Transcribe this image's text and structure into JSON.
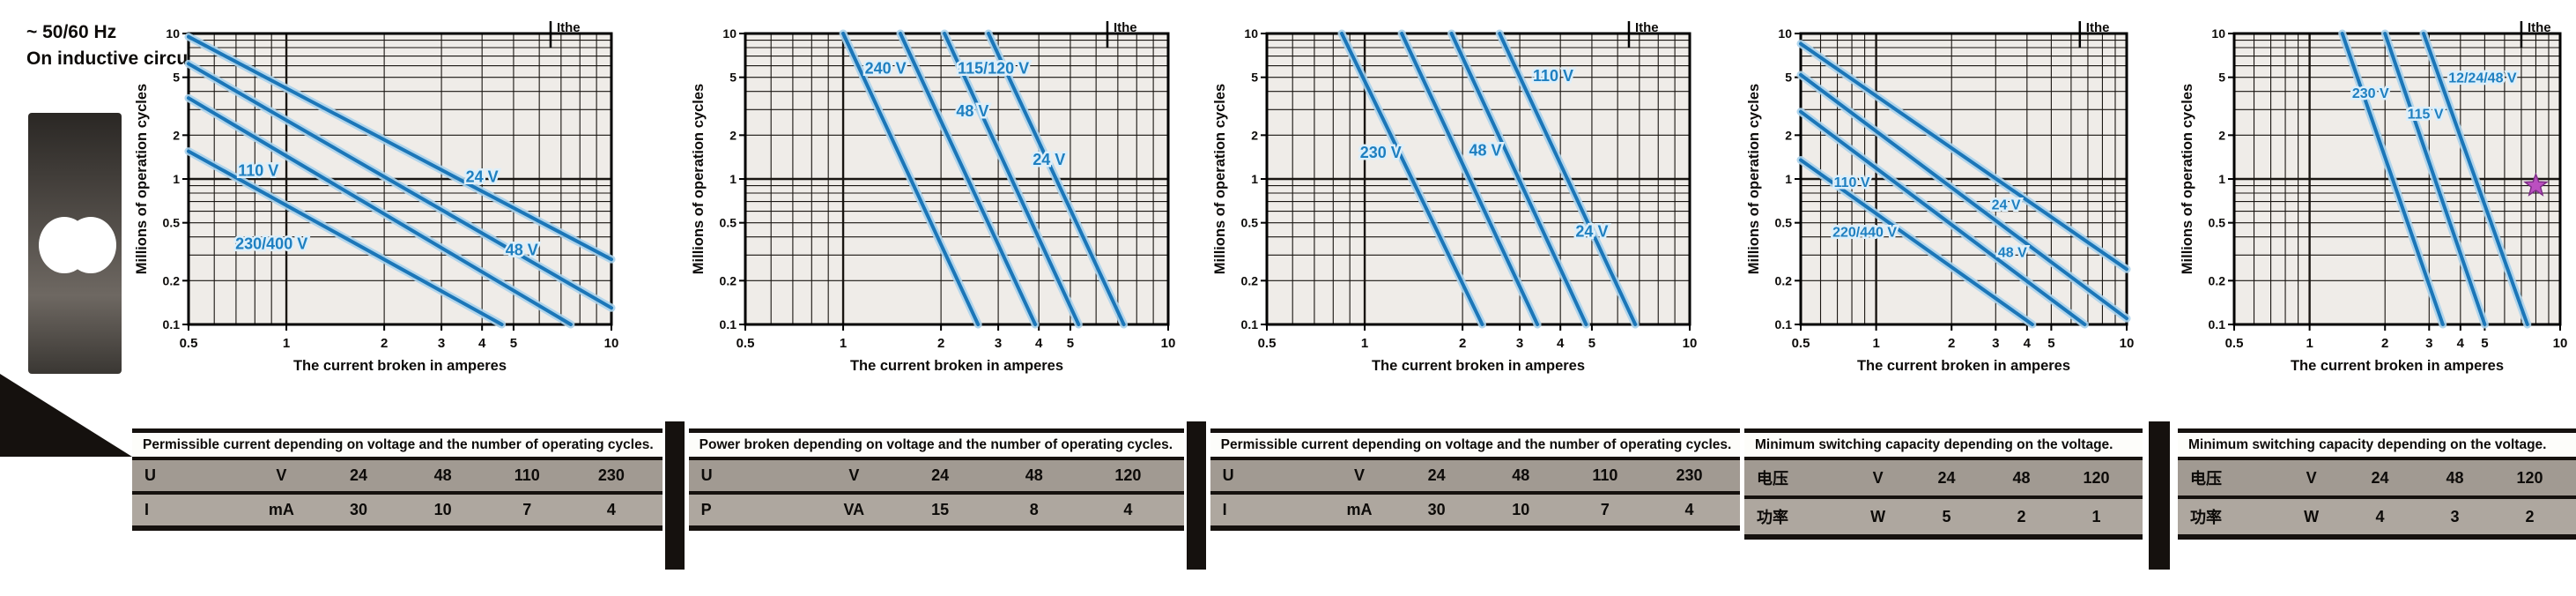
{
  "page": {
    "supply_annotation": "~ 50/60 Hz",
    "circuit_annotation": "On inductive circuit",
    "colors": {
      "curve_blue": "#1b76b8",
      "curve_halo": "#aad3ec",
      "label_blue": "#1e7fc0",
      "label_halo": "#ddeffa",
      "grid_dark": "#191511",
      "axis_black": "#000000",
      "star_magenta": "#bb4fc0",
      "table_grey": "#968f88"
    }
  },
  "chart_data": [
    {
      "id": "ac-durability-chart-1",
      "panel": "left",
      "type": "line",
      "log_x": true,
      "log_y": true,
      "xlim": [
        0.5,
        10
      ],
      "ylim": [
        0.1,
        10
      ],
      "x_ticks": [
        0.5,
        1,
        2,
        3,
        4,
        5,
        10
      ],
      "y_ticks": [
        10,
        5,
        2,
        1,
        0.5,
        0.2,
        0.1
      ],
      "ylabel": "Millions of operation cycles",
      "xlabel": "The current broken in amperes",
      "ithe_label": "Ithe",
      "ithe_x": 6.5,
      "grid": true,
      "marker": null,
      "series": [
        {
          "name": "24 V",
          "points": [
            [
              0.5,
              9.5
            ],
            [
              10,
              0.28
            ]
          ],
          "label_pos": [
            4.0,
            0.95
          ]
        },
        {
          "name": "48 V",
          "points": [
            [
              0.5,
              6.2
            ],
            [
              10,
              0.13
            ]
          ],
          "label_pos": [
            5.3,
            0.3
          ]
        },
        {
          "name": "110 V",
          "points": [
            [
              0.5,
              3.6
            ],
            [
              7.5,
              0.1
            ]
          ],
          "label_pos": [
            0.82,
            1.05
          ]
        },
        {
          "name": "230/400 V",
          "points": [
            [
              0.5,
              1.55
            ],
            [
              4.6,
              0.1
            ]
          ],
          "label_pos": [
            0.9,
            0.33
          ]
        }
      ]
    },
    {
      "id": "ac-durability-chart-2",
      "panel": "left",
      "type": "line",
      "log_x": true,
      "log_y": true,
      "xlim": [
        0.5,
        10
      ],
      "ylim": [
        0.1,
        10
      ],
      "x_ticks": [
        0.5,
        1,
        2,
        3,
        4,
        5,
        10
      ],
      "y_ticks": [
        10,
        5,
        2,
        1,
        0.5,
        0.2,
        0.1
      ],
      "ylabel": "Millions of operation cycles",
      "xlabel": "The current broken in amperes",
      "ithe_label": "Ithe",
      "ithe_x": 6.5,
      "grid": true,
      "marker": null,
      "series": [
        {
          "name": "240 V",
          "points": [
            [
              1.0,
              10
            ],
            [
              2.6,
              0.1
            ]
          ],
          "label_pos": [
            1.35,
            5.3
          ]
        },
        {
          "name": "115/120 V",
          "points": [
            [
              1.5,
              10
            ],
            [
              3.9,
              0.1
            ]
          ],
          "label_pos": [
            2.9,
            5.3
          ]
        },
        {
          "name": "48 V",
          "points": [
            [
              2.05,
              10
            ],
            [
              5.3,
              0.1
            ]
          ],
          "label_pos": [
            2.5,
            2.7
          ]
        },
        {
          "name": "24 V",
          "points": [
            [
              2.8,
              10
            ],
            [
              7.3,
              0.1
            ]
          ],
          "label_pos": [
            4.3,
            1.25
          ]
        }
      ]
    },
    {
      "id": "ac-durability-chart-3",
      "panel": "left",
      "type": "line",
      "log_x": true,
      "log_y": true,
      "xlim": [
        0.5,
        10
      ],
      "ylim": [
        0.1,
        10
      ],
      "x_ticks": [
        0.5,
        1,
        2,
        3,
        4,
        5,
        10
      ],
      "y_ticks": [
        10,
        5,
        2,
        1,
        0.5,
        0.2,
        0.1
      ],
      "ylabel": "Millions of operation cycles",
      "xlabel": "The current broken in amperes",
      "ithe_label": "Ithe",
      "ithe_x": 6.5,
      "grid": true,
      "marker": null,
      "series": [
        {
          "name": "230 V",
          "points": [
            [
              0.85,
              10
            ],
            [
              2.3,
              0.1
            ]
          ],
          "label_pos": [
            1.12,
            1.4
          ]
        },
        {
          "name": "110 V",
          "points": [
            [
              1.3,
              10
            ],
            [
              3.4,
              0.1
            ]
          ],
          "label_pos": [
            3.8,
            4.7
          ]
        },
        {
          "name": "48 V",
          "points": [
            [
              1.85,
              10
            ],
            [
              4.8,
              0.1
            ]
          ],
          "label_pos": [
            2.35,
            1.45
          ]
        },
        {
          "name": "24 V",
          "points": [
            [
              2.6,
              10
            ],
            [
              6.8,
              0.1
            ]
          ],
          "label_pos": [
            5.0,
            0.4
          ]
        }
      ]
    },
    {
      "id": "dc-durability-chart-1",
      "panel": "right",
      "type": "line",
      "log_x": true,
      "log_y": true,
      "xlim": [
        0.5,
        10
      ],
      "ylim": [
        0.1,
        10
      ],
      "x_ticks": [
        0.5,
        1,
        2,
        3,
        4,
        5,
        10
      ],
      "y_ticks": [
        10,
        5,
        2,
        1,
        0.5,
        0.2,
        0.1
      ],
      "ylabel": "Millions of operation cycles",
      "xlabel": "The current broken in amperes",
      "ithe_label": "Ithe",
      "ithe_x": 6.5,
      "grid": true,
      "marker": null,
      "series": [
        {
          "name": "24 V",
          "points": [
            [
              0.5,
              8.5
            ],
            [
              10,
              0.24
            ]
          ],
          "label_pos": [
            3.3,
            0.62
          ]
        },
        {
          "name": "48 V",
          "points": [
            [
              0.5,
              5.2
            ],
            [
              10,
              0.11
            ]
          ],
          "label_pos": [
            3.5,
            0.29
          ]
        },
        {
          "name": "110 V",
          "points": [
            [
              0.5,
              2.9
            ],
            [
              6.8,
              0.1
            ]
          ],
          "label_pos": [
            0.8,
            0.88
          ]
        },
        {
          "name": "220/440 V",
          "points": [
            [
              0.5,
              1.35
            ],
            [
              4.2,
              0.1
            ]
          ],
          "label_pos": [
            0.9,
            0.4
          ]
        }
      ]
    },
    {
      "id": "dc-durability-chart-2",
      "panel": "right",
      "type": "line",
      "log_x": true,
      "log_y": true,
      "xlim": [
        0.5,
        10
      ],
      "ylim": [
        0.1,
        10
      ],
      "x_ticks": [
        0.5,
        1,
        2,
        3,
        4,
        5,
        10
      ],
      "y_ticks": [
        10,
        5,
        2,
        1,
        0.5,
        0.2,
        0.1
      ],
      "ylabel": "Millions of operation cycles",
      "xlabel": "The current broken in amperes",
      "ithe_label": "Ithe",
      "ithe_x": 7.0,
      "grid": true,
      "marker": {
        "x": 8.0,
        "y": 0.9,
        "shape": "star"
      },
      "series": [
        {
          "name": "230 V",
          "points": [
            [
              1.35,
              10
            ],
            [
              3.4,
              0.1
            ]
          ],
          "label_pos": [
            1.75,
            3.6
          ]
        },
        {
          "name": "115 V",
          "points": [
            [
              2.0,
              10
            ],
            [
              5.0,
              0.1
            ]
          ],
          "label_pos": [
            2.9,
            2.6
          ]
        },
        {
          "name": "12/24/48 V",
          "points": [
            [
              2.85,
              10
            ],
            [
              7.4,
              0.1
            ]
          ],
          "label_pos": [
            4.9,
            4.6
          ]
        }
      ]
    }
  ],
  "tables": [
    {
      "header": "Permissible current depending on voltage and the number of operating cycles.",
      "rows": [
        {
          "label": "U",
          "unit": "V",
          "values": [
            "24",
            "48",
            "110",
            "230"
          ]
        },
        {
          "label": "I",
          "unit": "mA",
          "values": [
            "30",
            "10",
            "7",
            "4"
          ]
        }
      ]
    },
    {
      "header": "Power broken depending on voltage and the number of operating cycles.",
      "rows": [
        {
          "label": "U",
          "unit": "V",
          "values": [
            "24",
            "48",
            "120"
          ]
        },
        {
          "label": "P",
          "unit": "VA",
          "values": [
            "15",
            "8",
            "4"
          ]
        }
      ]
    },
    {
      "header": "Permissible current depending on voltage and the number of operating cycles.",
      "rows": [
        {
          "label": "U",
          "unit": "V",
          "values": [
            "24",
            "48",
            "110",
            "230"
          ]
        },
        {
          "label": "I",
          "unit": "mA",
          "values": [
            "30",
            "10",
            "7",
            "4"
          ]
        }
      ]
    },
    {
      "header": "Minimum switching capacity depending on the voltage.",
      "rows": [
        {
          "label": "电压",
          "unit": "V",
          "values": [
            "24",
            "48",
            "120"
          ]
        },
        {
          "label": "功率",
          "unit": "W",
          "values": [
            "5",
            "2",
            "1"
          ]
        }
      ]
    },
    {
      "header": "Minimum switching capacity depending on the voltage.",
      "rows": [
        {
          "label": "电压",
          "unit": "V",
          "values": [
            "24",
            "48",
            "120"
          ]
        },
        {
          "label": "功率",
          "unit": "W",
          "values": [
            "4",
            "3",
            "2"
          ]
        }
      ]
    }
  ]
}
